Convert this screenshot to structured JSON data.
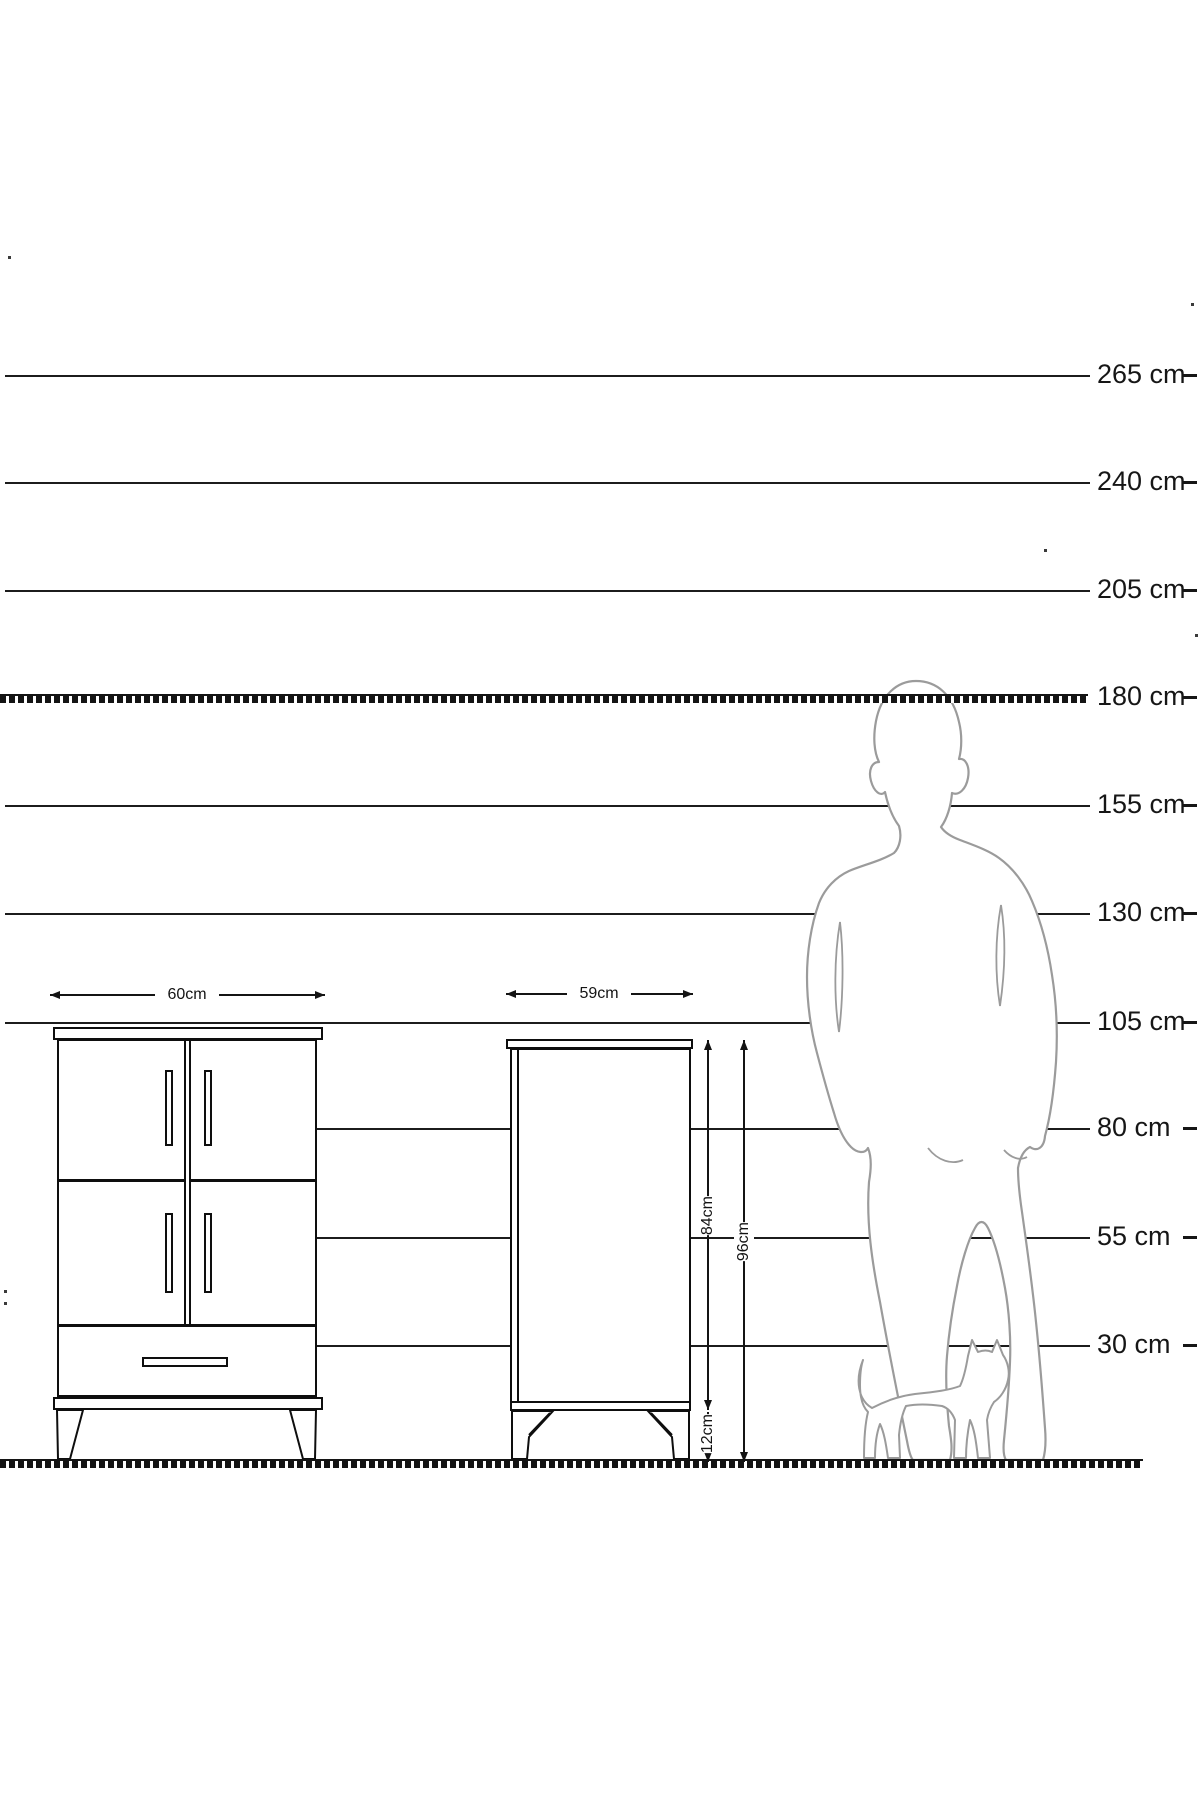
{
  "ruler": {
    "labels": [
      "265 cm",
      "240 cm",
      "205 cm",
      "180 cm",
      "155 cm",
      "130 cm",
      "105 cm",
      "80 cm",
      "55 cm",
      "30 cm"
    ],
    "values_cm": [
      265,
      240,
      205,
      180,
      155,
      130,
      105,
      80,
      55,
      30
    ],
    "unit": "cm"
  },
  "dimensions": {
    "front_width": "60cm",
    "side_width": "59cm",
    "carcass_height": "84cm",
    "total_height": "96cm",
    "leg_height": "12cm"
  },
  "figures": {
    "person": "standing-man-silhouette",
    "cat": "walking-cat-silhouette"
  },
  "colors": {
    "line": "#1c1c1c",
    "silhouette": "#9b9b9b",
    "background": "#ffffff"
  }
}
